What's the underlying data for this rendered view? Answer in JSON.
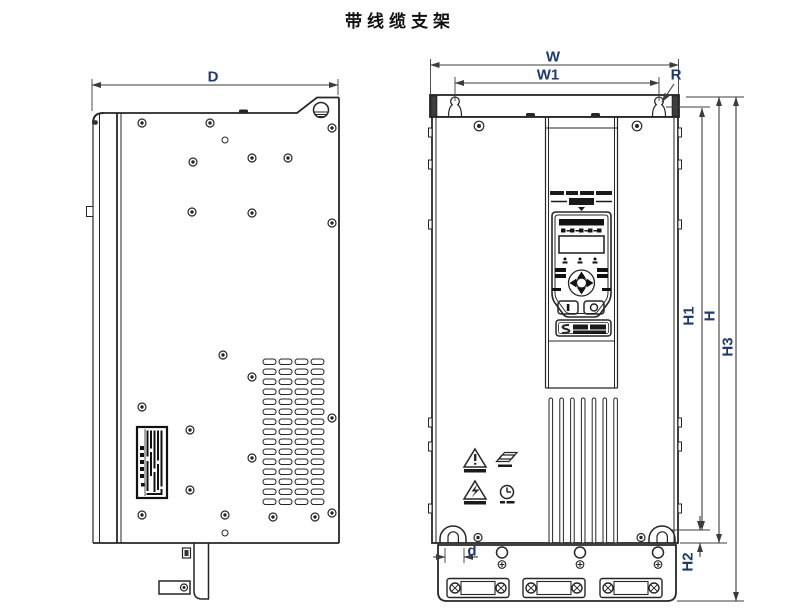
{
  "title": "带线缆支架",
  "dimension_labels": {
    "D": "D",
    "W": "W",
    "W1": "W1",
    "R": "R",
    "H1": "H1",
    "H": "H",
    "H2": "H2",
    "H3": "H3",
    "d": "d"
  },
  "colors": {
    "line": "#262626",
    "dimension_line": "#3c3c3c",
    "dimension_label": "#1e3a6e",
    "background": "#ffffff"
  }
}
